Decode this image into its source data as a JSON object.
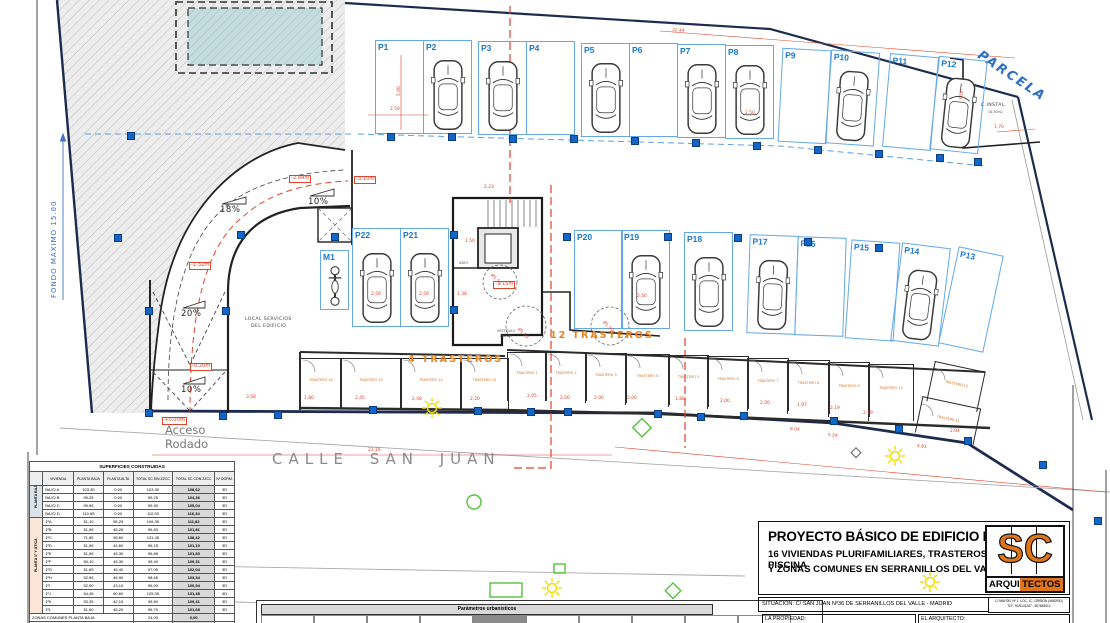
{
  "colors": {
    "blue_label": "#1878d0",
    "space_border": "#64a8e8",
    "red": "#e0442a",
    "orange": "#e8821e",
    "navy": "#1d2b4f",
    "pool": "#c6dde0",
    "logo_orange": "#e0761c",
    "green": "#55c23c",
    "yellow": "#f0df00",
    "gray_text": "#8a8a8a"
  },
  "plan": {
    "street_label": "CALLE  SAN  JUAN",
    "acceso_line1": "Acceso",
    "acceso_line2": "Rodado",
    "parcela_label": "PARCELA",
    "fondo_label": "FONDO MÁXIMO 15.00",
    "parking_top": [
      {
        "label": "P1",
        "x": 375,
        "y": 40
      },
      {
        "label": "P2",
        "x": 423,
        "y": 40,
        "car": true
      },
      {
        "label": "P3",
        "x": 478,
        "y": 41,
        "car": true
      },
      {
        "label": "P4",
        "x": 526,
        "y": 41
      },
      {
        "label": "P5",
        "x": 581,
        "y": 43,
        "car": true
      },
      {
        "label": "P6",
        "x": 629,
        "y": 43
      },
      {
        "label": "P7",
        "x": 677,
        "y": 44,
        "car": true
      },
      {
        "label": "P8",
        "x": 725,
        "y": 45,
        "car": true
      },
      {
        "label": "P9",
        "x": 780,
        "y": 49,
        "r": 3
      },
      {
        "label": "P10",
        "x": 828,
        "y": 51,
        "car": true,
        "r": 4
      },
      {
        "label": "P11",
        "x": 886,
        "y": 55,
        "r": 5
      },
      {
        "label": "P12",
        "x": 934,
        "y": 58,
        "car": true,
        "r": 6
      }
    ],
    "parking_mid": [
      {
        "label": "P22",
        "x": 352,
        "y": 228,
        "car": true
      },
      {
        "label": "P21",
        "x": 400,
        "y": 228,
        "car": true
      },
      {
        "label": "P20",
        "x": 574,
        "y": 230
      },
      {
        "label": "P19",
        "x": 621,
        "y": 230,
        "car": true
      },
      {
        "label": "P18",
        "x": 684,
        "y": 232,
        "car": true
      },
      {
        "label": "P17",
        "x": 748,
        "y": 235,
        "car": true,
        "r": 2
      },
      {
        "label": "P16",
        "x": 796,
        "y": 237,
        "r": 2
      },
      {
        "label": "P15",
        "x": 848,
        "y": 241,
        "r": 4
      },
      {
        "label": "P14",
        "x": 896,
        "y": 245,
        "car": true,
        "r": 7
      },
      {
        "label": "P13",
        "x": 948,
        "y": 250,
        "w": 44,
        "r": 12
      }
    ],
    "moto": {
      "label": "M1",
      "x": 320,
      "y": 250,
      "w": 27,
      "h": 58
    },
    "trasteros_left": [
      {
        "label": "TRASTERO 16",
        "x": 300,
        "y": 358,
        "w": 40,
        "h": 50
      },
      {
        "label": "TRASTERO 15",
        "x": 340,
        "y": 358,
        "w": 60,
        "h": 50
      },
      {
        "label": "TRASTERO 14",
        "x": 400,
        "y": 358,
        "w": 60,
        "h": 50
      },
      {
        "label": "TRASTERO 13",
        "x": 460,
        "y": 358,
        "w": 47,
        "h": 50
      }
    ],
    "trasteros_right": [
      {
        "label": "TRASTERO 1",
        "x": 507,
        "y": 352,
        "w": 38,
        "h": 48
      },
      {
        "label": "TRASTERO 2",
        "x": 545,
        "y": 352,
        "w": 40,
        "h": 48
      },
      {
        "label": "TRASTERO 3",
        "x": 585,
        "y": 353,
        "w": 40,
        "h": 49
      },
      {
        "label": "TRASTERO 4",
        "x": 625,
        "y": 354,
        "w": 43,
        "h": 50
      },
      {
        "label": "TRASTERO 5",
        "x": 668,
        "y": 355,
        "w": 39,
        "h": 51
      },
      {
        "label": "TRASTERO 6",
        "x": 707,
        "y": 356,
        "w": 40,
        "h": 52
      },
      {
        "label": "TRASTERO 7",
        "x": 747,
        "y": 358,
        "w": 40,
        "h": 52
      },
      {
        "label": "TRASTERO 8",
        "x": 787,
        "y": 360,
        "w": 41,
        "h": 53
      },
      {
        "label": "TRASTERO 9",
        "x": 828,
        "y": 362,
        "w": 40,
        "h": 54
      },
      {
        "label": "TRASTERO 10",
        "x": 868,
        "y": 364,
        "w": 44,
        "h": 56
      },
      {
        "label": "TRASTERO 12",
        "x": 930,
        "y": 366,
        "w": 50,
        "h": 40,
        "r": 12
      },
      {
        "label": "TRASTERO 11",
        "x": 918,
        "y": 402,
        "w": 58,
        "h": 36,
        "r": 12
      }
    ],
    "columns": [
      [
        130,
        135
      ],
      [
        117,
        237
      ],
      [
        148,
        310
      ],
      [
        225,
        310
      ],
      [
        148,
        412
      ],
      [
        222,
        415
      ],
      [
        277,
        414
      ],
      [
        390,
        136
      ],
      [
        451,
        136
      ],
      [
        512,
        138
      ],
      [
        573,
        138
      ],
      [
        634,
        140
      ],
      [
        695,
        142
      ],
      [
        756,
        145
      ],
      [
        817,
        149
      ],
      [
        878,
        153
      ],
      [
        939,
        157
      ],
      [
        977,
        161
      ],
      [
        240,
        234
      ],
      [
        334,
        236
      ],
      [
        453,
        234
      ],
      [
        453,
        309
      ],
      [
        566,
        236
      ],
      [
        667,
        236
      ],
      [
        737,
        237
      ],
      [
        807,
        241
      ],
      [
        878,
        247
      ],
      [
        372,
        409
      ],
      [
        477,
        410
      ],
      [
        530,
        411
      ],
      [
        567,
        411
      ],
      [
        657,
        413
      ],
      [
        700,
        416
      ],
      [
        743,
        415
      ],
      [
        833,
        420
      ],
      [
        898,
        428
      ],
      [
        967,
        440
      ],
      [
        1042,
        464
      ],
      [
        1097,
        520
      ]
    ],
    "annotations": [
      {
        "t": "18%",
        "x": 220,
        "y": 206,
        "c": "slope"
      },
      {
        "t": "10%",
        "x": 308,
        "y": 198,
        "c": "slope"
      },
      {
        "t": "20%",
        "x": 181,
        "y": 310,
        "c": "slope"
      },
      {
        "t": "10%",
        "x": 181,
        "y": 386,
        "c": "slope"
      },
      {
        "t": "+0.00m",
        "x": 162,
        "y": 417,
        "c": "lvl"
      },
      {
        "t": "-0.20m",
        "x": 190,
        "y": 363,
        "c": "lvl"
      },
      {
        "t": "-1.32m",
        "x": 189,
        "y": 262,
        "c": "lvl"
      },
      {
        "t": "-2.84m",
        "x": 289,
        "y": 175,
        "c": "lvl"
      },
      {
        "t": "-3.10m",
        "x": 354,
        "y": 176,
        "c": "lvl"
      },
      {
        "t": "-3.15m",
        "x": 493,
        "y": 281,
        "c": "lvl"
      },
      {
        "t": "4  TRASTEROS",
        "x": 408,
        "y": 355,
        "c": "org"
      },
      {
        "t": "12  TRASTEROS",
        "x": 550,
        "y": 331,
        "c": "org"
      },
      {
        "t": "LOCAL  SERVICIOS",
        "x": 245,
        "y": 317,
        "c": "tiny"
      },
      {
        "t": "DEL  EDIFICIO",
        "x": 251,
        "y": 324,
        "c": "tiny"
      },
      {
        "t": "C.INSTAL.",
        "x": 981,
        "y": 103,
        "c": "tiny"
      },
      {
        "t": "10,50m2",
        "x": 988,
        "y": 111,
        "c": "tiny2"
      },
      {
        "t": "ASEO",
        "x": 459,
        "y": 262,
        "c": "tiny2"
      },
      {
        "t": "VESTÍBULO",
        "x": 497,
        "y": 330,
        "c": "tiny2"
      },
      {
        "t": "PREVIO",
        "x": 500,
        "y": 335,
        "c": "tiny2"
      },
      {
        "t": "2.50",
        "x": 390,
        "y": 108,
        "c": "dim"
      },
      {
        "t": "5.00",
        "x": 398,
        "y": 96,
        "c": "dim",
        "r": -90
      },
      {
        "t": "2.50",
        "x": 745,
        "y": 112,
        "c": "dim"
      },
      {
        "t": "32.44",
        "x": 672,
        "y": 29,
        "c": "dim",
        "r": 4
      },
      {
        "t": "3.50",
        "x": 960,
        "y": 100,
        "c": "dim",
        "r": -85
      },
      {
        "t": "1.70",
        "x": 994,
        "y": 126,
        "c": "dim"
      },
      {
        "t": "21.19",
        "x": 368,
        "y": 449,
        "c": "dim"
      },
      {
        "t": "8.04",
        "x": 790,
        "y": 428,
        "c": "dim",
        "r": 4
      },
      {
        "t": "5.24",
        "x": 828,
        "y": 434,
        "c": "dim",
        "r": 5
      },
      {
        "t": "4.83",
        "x": 917,
        "y": 445,
        "c": "dim",
        "r": 6
      },
      {
        "t": "3.58",
        "x": 246,
        "y": 396,
        "c": "dim"
      },
      {
        "t": "1.80",
        "x": 304,
        "y": 397,
        "c": "dim"
      },
      {
        "t": "2.45",
        "x": 355,
        "y": 397,
        "c": "dim"
      },
      {
        "t": "2.48",
        "x": 412,
        "y": 398,
        "c": "dim"
      },
      {
        "t": "2.20",
        "x": 470,
        "y": 398,
        "c": "dim"
      },
      {
        "t": "2.05",
        "x": 527,
        "y": 395,
        "c": "dim"
      },
      {
        "t": "2.00",
        "x": 560,
        "y": 397,
        "c": "dim"
      },
      {
        "t": "2.00",
        "x": 594,
        "y": 397,
        "c": "dim"
      },
      {
        "t": "2.00",
        "x": 627,
        "y": 397,
        "c": "dim"
      },
      {
        "t": "1.88",
        "x": 675,
        "y": 398,
        "c": "dim"
      },
      {
        "t": "2.00",
        "x": 720,
        "y": 400,
        "c": "dim"
      },
      {
        "t": "2.00",
        "x": 760,
        "y": 402,
        "c": "dim"
      },
      {
        "t": "1.97",
        "x": 797,
        "y": 404,
        "c": "dim"
      },
      {
        "t": "2.19",
        "x": 830,
        "y": 407,
        "c": "dim"
      },
      {
        "t": "2.19",
        "x": 863,
        "y": 412,
        "c": "dim"
      },
      {
        "t": "2.04",
        "x": 950,
        "y": 430,
        "c": "dim"
      },
      {
        "t": "2.50",
        "x": 371,
        "y": 293,
        "c": "dim"
      },
      {
        "t": "2.50",
        "x": 419,
        "y": 293,
        "c": "dim"
      },
      {
        "t": "2.50",
        "x": 637,
        "y": 295,
        "c": "dim"
      },
      {
        "t": "2.23",
        "x": 484,
        "y": 186,
        "c": "dim"
      },
      {
        "t": "1.50",
        "x": 465,
        "y": 240,
        "c": "dim"
      },
      {
        "t": "1.38",
        "x": 457,
        "y": 293,
        "c": "dim"
      },
      {
        "t": "Ø1.50",
        "x": 492,
        "y": 274,
        "c": "dim",
        "r": 45
      },
      {
        "t": "Ø1.50",
        "x": 519,
        "y": 328,
        "c": "dim",
        "r": 45
      },
      {
        "t": "Ø1.50",
        "x": 604,
        "y": 321,
        "c": "dim",
        "r": 45
      }
    ]
  },
  "tables": {
    "superficies": {
      "title": "SUPERFICIES CONSTRUIDAS",
      "headers": [
        "VIVIENDA",
        "PLANTA BAJA",
        "PLANTA ALTA",
        "TOTAL SC SIN ZZCC",
        "TOTAL SC CON ZZCC",
        "Nº DORM."
      ],
      "groups": [
        {
          "label": "PLANTA BAJA",
          "color": "#dbe2ea",
          "rows": [
            [
              "BAJO A",
              "103,30",
              "0,00",
              "103,30",
              "108,62",
              "3D"
            ],
            [
              "BAJO B",
              "99,25",
              "0,00",
              "99,25",
              "104,36",
              "3D"
            ],
            [
              "BAJO C",
              "99,95",
              "0,00",
              "99,90",
              "105,04",
              "3D"
            ],
            [
              "BAJO D",
              "110,65",
              "0,00",
              "110,93",
              "116,34",
              "3D"
            ]
          ]
        },
        {
          "label": "PLANTA 1ª Y ÁTICA",
          "color": "#fbe5d6",
          "rows": [
            [
              "1ºA",
              "51,10",
              "55,25",
              "106,35",
              "111,82",
              "3D"
            ],
            [
              "1ºB",
              "51,55",
              "45,28",
              "96,83",
              "101,81",
              "3D"
            ],
            [
              "1ºC",
              "71,85",
              "59,60",
              "131,45",
              "138,42",
              "3D"
            ],
            [
              "1ºD",
              "51,55",
              "44,60",
              "96,15",
              "101,10",
              "3D"
            ],
            [
              "1ºE",
              "51,55",
              "45,30",
              "96,85",
              "101,83",
              "3D"
            ],
            [
              "1ºF",
              "50,10",
              "45,30",
              "95,40",
              "100,31",
              "3D"
            ],
            [
              "1ºG",
              "51,65",
              "45,40",
              "97,05",
              "102,04",
              "3D"
            ],
            [
              "1ºH",
              "52,95",
              "45,90",
              "98,65",
              "103,34",
              "3D"
            ],
            [
              "1ºI",
              "52,90",
              "43,10",
              "96,00",
              "100,94",
              "3D"
            ],
            [
              "1ºJ",
              "64,45",
              "60,60",
              "125,05",
              "131,48",
              "4D"
            ],
            [
              "1ºK",
              "53,35",
              "42,15",
              "95,50",
              "100,41",
              "3D"
            ],
            [
              "1ºL",
              "51,50",
              "45,20",
              "96,70",
              "101,68",
              "3D"
            ]
          ]
        }
      ],
      "footer": [
        [
          "ZONAS COMUNES PLANTA BAJA",
          "24,00",
          "0,00"
        ],
        [
          "ZONAS COMUNES PLANTA PRIMERA",
          "60,67",
          "0,00"
        ],
        [
          "TOTAL ZONAS COMUNES",
          "84,67",
          "0,00"
        ],
        [
          "TOTAL VIVIENDA",
          "1645,46",
          "1730,15"
        ]
      ]
    },
    "parametros": {
      "title": "Parámetros urbanísticos"
    }
  },
  "titleblock": {
    "line1": "PROYECTO BÁSICO DE EDIFICIO DE",
    "line2": "16 VIVIENDAS PLURIFAMILIARES, TRASTEROS , GARAJE, PISCINA",
    "line3": "Y ZONAS COMUNES EN  SERRANILLOS DEL VALLE - MADRID",
    "logo_sc": "SC",
    "logo_arqui": "ARQUI",
    "logo_tectos": "TECTOS",
    "situacion": "SITUACIÓN: C/ SAN JUAN Nº36  DE  SERRANILLOS  DEL  VALLE  -  MADRID",
    "contact_line1": "C/ MAYOR, Nº 1, LOC. 1C, GRIÑÓN (MADRID)",
    "contact_line2": "TLF: 91/8141287  -  607653612",
    "propiedad": "LA PROPIEDAD:",
    "arquitecto": "EL ARQUITECTO:"
  }
}
